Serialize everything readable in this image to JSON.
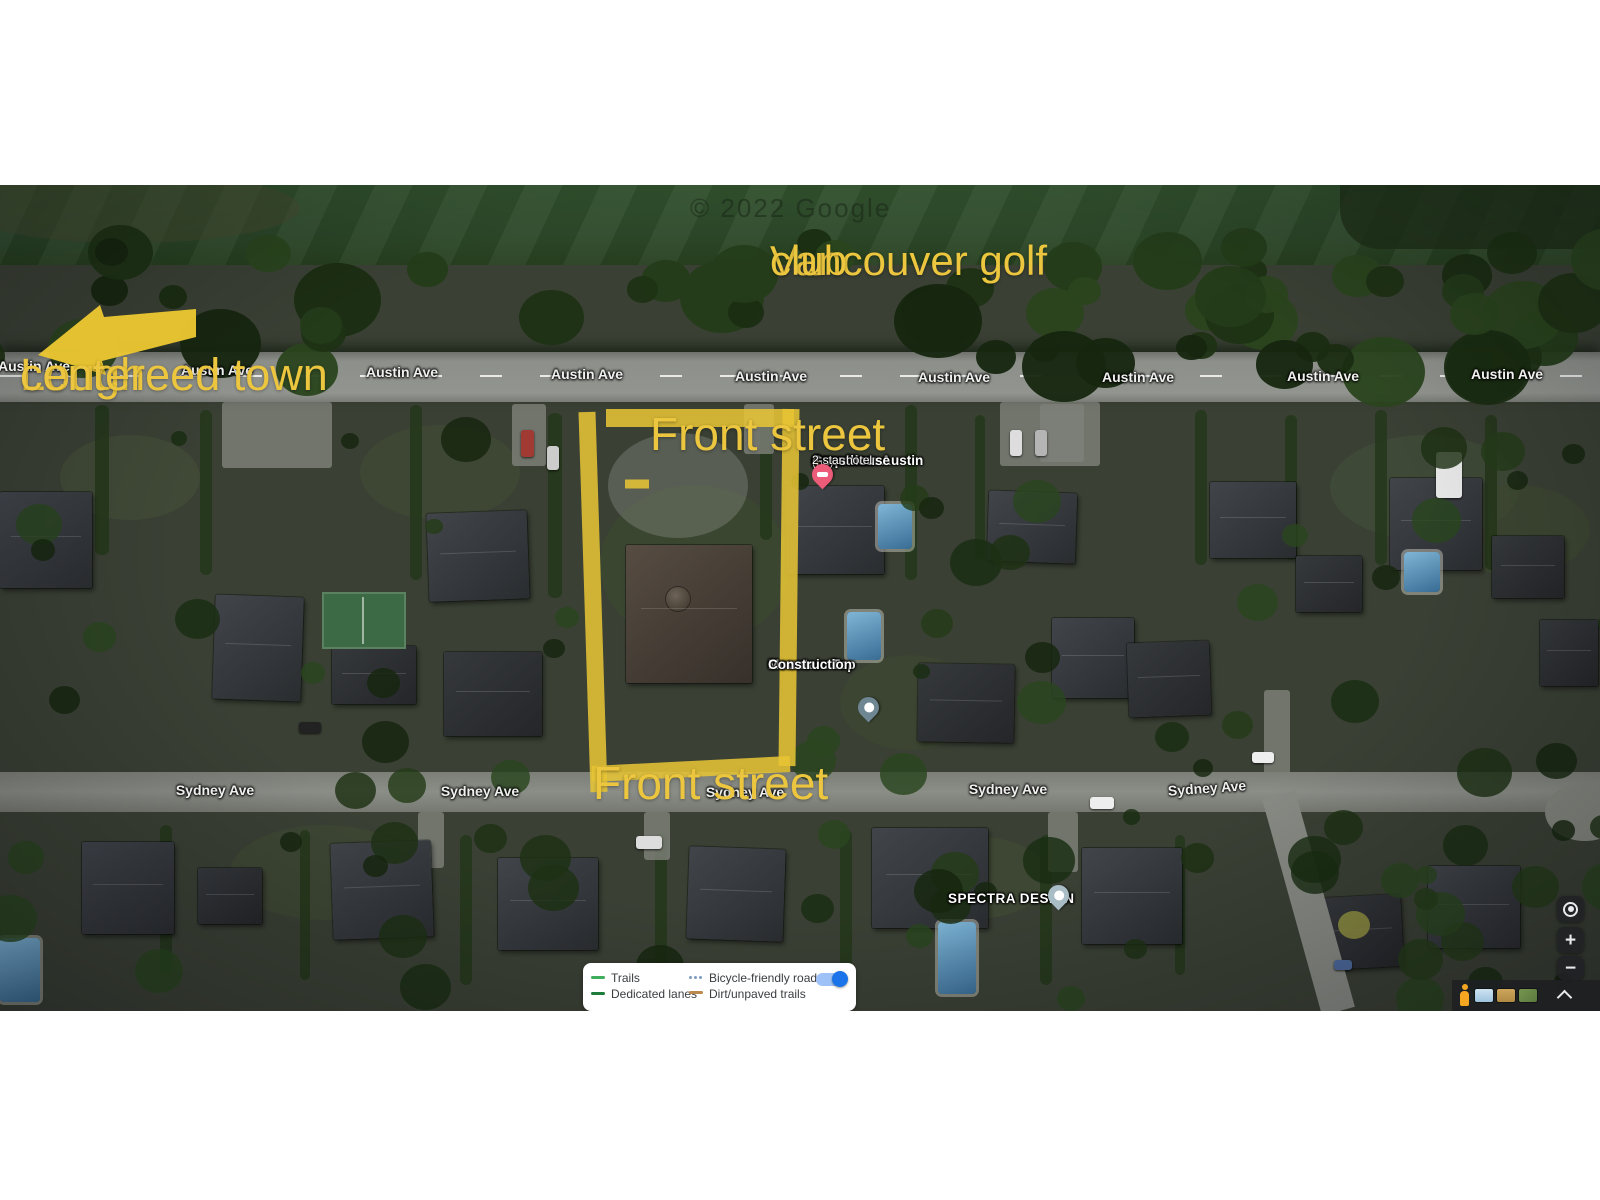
{
  "annotations": {
    "golf_club_line1": "Vancouver golf",
    "golf_club_line2": "club",
    "town_center_line1": "Lougheed town",
    "town_center_line2": "center",
    "front_street_top": "Front street",
    "front_street_bottom": "Front street",
    "highlight_color": "#ecc63e"
  },
  "streets": {
    "austin": [
      "Austin Ave",
      "Austin Ave",
      "Austin Ave",
      "Austin Ave",
      "Austin Ave",
      "Austin Ave",
      "Austin Ave",
      "Austin Ave",
      "Austin Ave"
    ],
    "sydney": [
      "Sydney Ave",
      "Sydney Ave",
      "Sydney Ave",
      "Sydney Ave",
      "Sydney Ave"
    ]
  },
  "pois": {
    "guesthouse": {
      "name_line1": "Coquitlam Austin",
      "name_line2": "Guesthouse",
      "rating": "1.7",
      "star": "★",
      "review_count": "(55)",
      "category": "2-star hotel",
      "pin_color": "#ec5b78"
    },
    "construction": {
      "name_line1": "Mountain Top",
      "name_line2": "Construction",
      "pin_color": "#6f8793"
    },
    "spectra": {
      "name": "SPECTRA DESIGN",
      "pin_color": "#a9bdc6"
    }
  },
  "legend": {
    "items": [
      {
        "label": "Trails",
        "color": "#3fae5c",
        "style": "dash"
      },
      {
        "label": "Dedicated lanes",
        "color": "#1d7c39",
        "style": "dash"
      },
      {
        "label": "Bicycle-friendly roads",
        "color": "#7e9cc0",
        "style": "dots"
      },
      {
        "label": "Dirt/unpaved trails",
        "color": "#b9894e",
        "style": "dash"
      }
    ],
    "toggle": {
      "on": true,
      "track_color": "#9ec2f7",
      "knob_color": "#1a73e8"
    }
  },
  "watermark": "© 2022 Google",
  "controls": {
    "zoom_in": "+",
    "zoom_out": "−"
  }
}
